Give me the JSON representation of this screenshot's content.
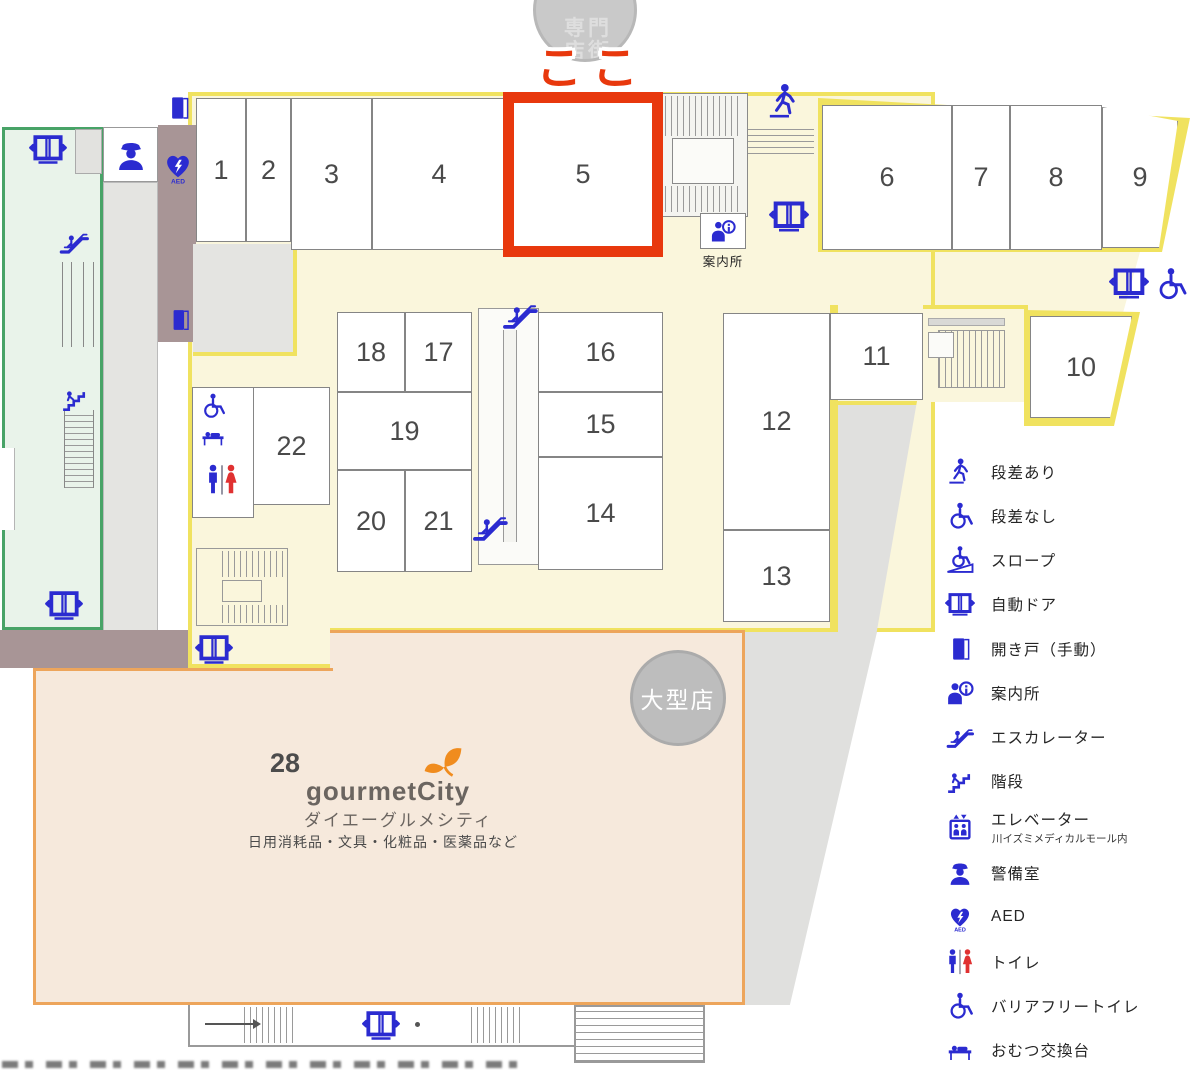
{
  "map": {
    "here_label": "ここ",
    "top_circle_label": "専門店街",
    "info_desk_label": "案内所",
    "large_store_badge": "大型店"
  },
  "stores": [
    {
      "id": "s1",
      "label": "1"
    },
    {
      "id": "s2",
      "label": "2"
    },
    {
      "id": "s3",
      "label": "3"
    },
    {
      "id": "s4",
      "label": "4"
    },
    {
      "id": "s5",
      "label": "5"
    },
    {
      "id": "s6",
      "label": "6"
    },
    {
      "id": "s7",
      "label": "7"
    },
    {
      "id": "s8",
      "label": "8"
    },
    {
      "id": "s9",
      "label": "9"
    },
    {
      "id": "s10",
      "label": "10"
    },
    {
      "id": "s11",
      "label": "11"
    },
    {
      "id": "s12",
      "label": "12"
    },
    {
      "id": "s13",
      "label": "13"
    },
    {
      "id": "s14",
      "label": "14"
    },
    {
      "id": "s15",
      "label": "15"
    },
    {
      "id": "s16",
      "label": "16"
    },
    {
      "id": "s17",
      "label": "17"
    },
    {
      "id": "s18",
      "label": "18"
    },
    {
      "id": "s19",
      "label": "19"
    },
    {
      "id": "s20",
      "label": "20"
    },
    {
      "id": "s21",
      "label": "21"
    },
    {
      "id": "s22",
      "label": "22"
    }
  ],
  "gourmet": {
    "number": "28",
    "logo": "gourmetCity",
    "name": "ダイエーグルメシティ",
    "desc": "日用消耗品・文具・化粧品・医薬品など"
  },
  "legend": {
    "items": [
      {
        "icon": "walker",
        "label": "段差あり"
      },
      {
        "icon": "wheelchair",
        "label": "段差なし"
      },
      {
        "icon": "slope",
        "label": "スロープ"
      },
      {
        "icon": "autodoor",
        "label": "自動ドア"
      },
      {
        "icon": "door",
        "label": "開き戸（手動）"
      },
      {
        "icon": "info",
        "label": "案内所"
      },
      {
        "icon": "escalator",
        "label": "エスカレーター"
      },
      {
        "icon": "stairs",
        "label": "階段"
      },
      {
        "icon": "elevator",
        "label": "エレベーター",
        "sub": "川イズミメディカルモール内"
      },
      {
        "icon": "guard",
        "label": "警備室"
      },
      {
        "icon": "aed",
        "label": "AED"
      },
      {
        "icon": "toilet",
        "label": "トイレ"
      },
      {
        "icon": "wheelchair",
        "label": "バリアフリートイレ"
      },
      {
        "icon": "diaper",
        "label": "おむつ交換台"
      }
    ]
  },
  "colors": {
    "highlight_red": "#e8380d",
    "icon_blue": "#2b2bd0",
    "floor_yellow": "#faf6dc",
    "boundary_yellow": "#f0e25f",
    "large_store_fill": "#f6e9dc",
    "large_store_border": "#eda55b",
    "green_zone": "#e9f3ea",
    "mauve": "#a89596",
    "leaf_orange": "#f08c1e"
  }
}
